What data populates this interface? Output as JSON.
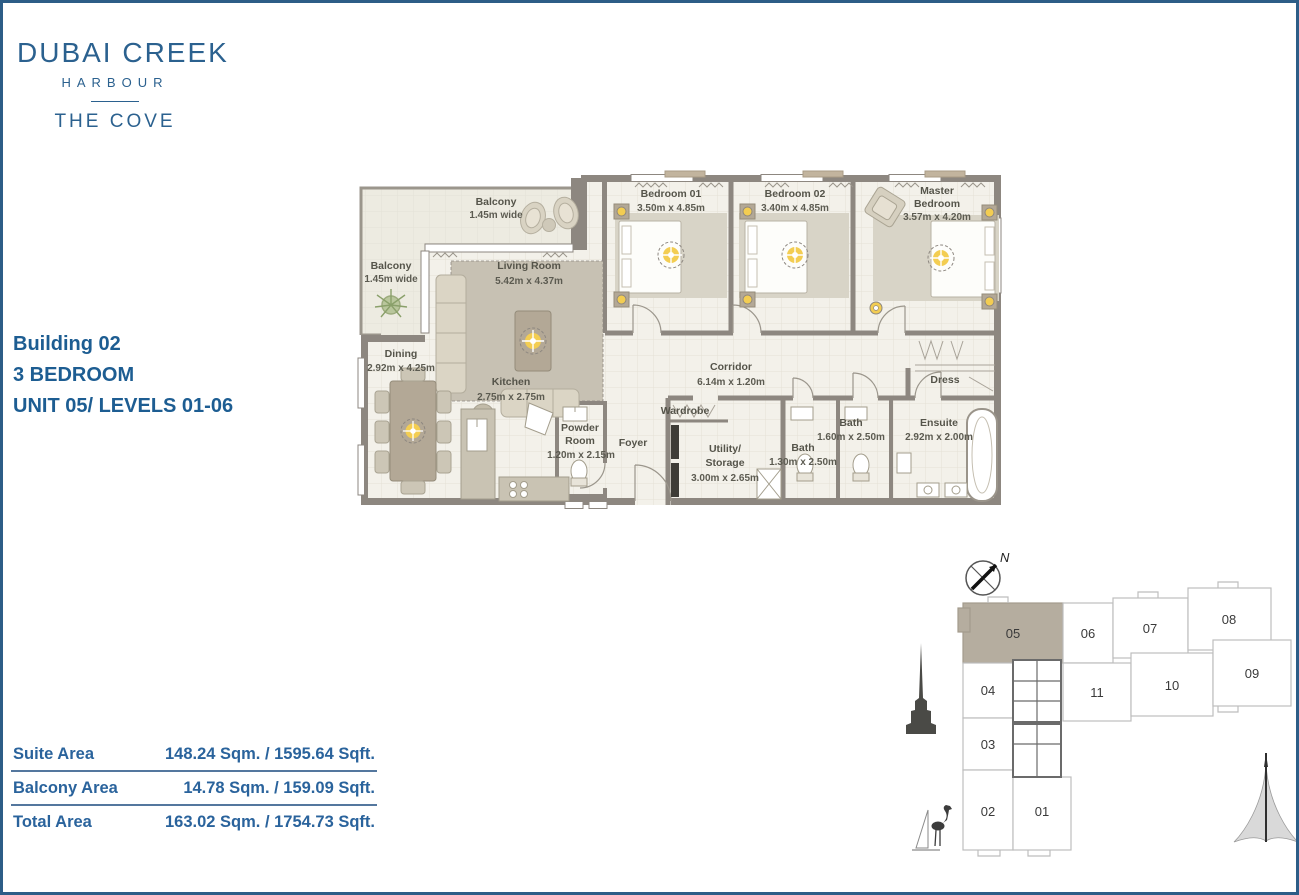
{
  "brand": {
    "title": "DUBAI CREEK",
    "subtitle": "HARBOUR",
    "project": "THE COVE"
  },
  "unit_info": {
    "building": "Building 02",
    "bedrooms": "3 BEDROOM",
    "unit_levels": "UNIT 05/ LEVELS 01-06"
  },
  "area_table": {
    "rows": [
      {
        "label": "Suite Area",
        "value": "148.24 Sqm. / 1595.64 Sqft."
      },
      {
        "label": "Balcony Area",
        "value": "14.78 Sqm. / 159.09 Sqft."
      },
      {
        "label": "Total Area",
        "value": "163.02 Sqm. / 1754.73 Sqft."
      }
    ]
  },
  "floorplan": {
    "rooms": {
      "balcony_top": {
        "name": "Balcony",
        "dims": "1.45m wide"
      },
      "balcony_left": {
        "name": "Balcony",
        "dims": "1.45m wide"
      },
      "living": {
        "name": "Living Room",
        "dims": "5.42m x 4.37m"
      },
      "dining": {
        "name": "Dining",
        "dims": "2.92m x 4.25m"
      },
      "kitchen": {
        "name": "Kitchen",
        "dims": "2.75m x 2.75m"
      },
      "bedroom1": {
        "name": "Bedroom 01",
        "dims": "3.50m x 4.85m"
      },
      "bedroom2": {
        "name": "Bedroom 02",
        "dims": "3.40m x 4.85m"
      },
      "master": {
        "line1": "Master",
        "line2": "Bedroom",
        "dims": "3.57m x 4.20m"
      },
      "corridor": {
        "name": "Corridor",
        "dims": "6.14m x 1.20m"
      },
      "powder": {
        "line1": "Powder",
        "line2": "Room",
        "dims": "1.20m x 2.15m"
      },
      "foyer": {
        "name": "Foyer"
      },
      "wardrobe": {
        "name": "Wardrobe"
      },
      "utility": {
        "line1": "Utility/",
        "line2": "Storage",
        "dims": "3.00m x 2.65m"
      },
      "bath1": {
        "name": "Bath",
        "dims": "1.30m x 2.50m"
      },
      "bath2": {
        "name": "Bath",
        "dims": "1.60m x 2.50m"
      },
      "ensuite": {
        "name": "Ensuite",
        "dims": "2.92m x 2.00m"
      },
      "dress": {
        "name": "Dress"
      }
    }
  },
  "keyplan": {
    "north": "N",
    "highlighted_unit": "05",
    "highlight_color": "#b5ad9f",
    "units": {
      "u01": "01",
      "u02": "02",
      "u03": "03",
      "u04": "04",
      "u05": "05",
      "u06": "06",
      "u07": "07",
      "u08": "08",
      "u09": "09",
      "u10": "10",
      "u11": "11"
    }
  },
  "colors": {
    "accent_blue": "#2b618f",
    "info_blue": "#1d5d92",
    "table_blue": "#2a639c",
    "border_blue": "#2d5d87",
    "wall_gray": "#8d8780",
    "floor_cream": "#f3f1ea",
    "balcony_floor": "#edebe1",
    "rug_tan": "#c7c1b3",
    "furniture_tan": "#b3a896",
    "light_gold": "#f3cd52"
  }
}
